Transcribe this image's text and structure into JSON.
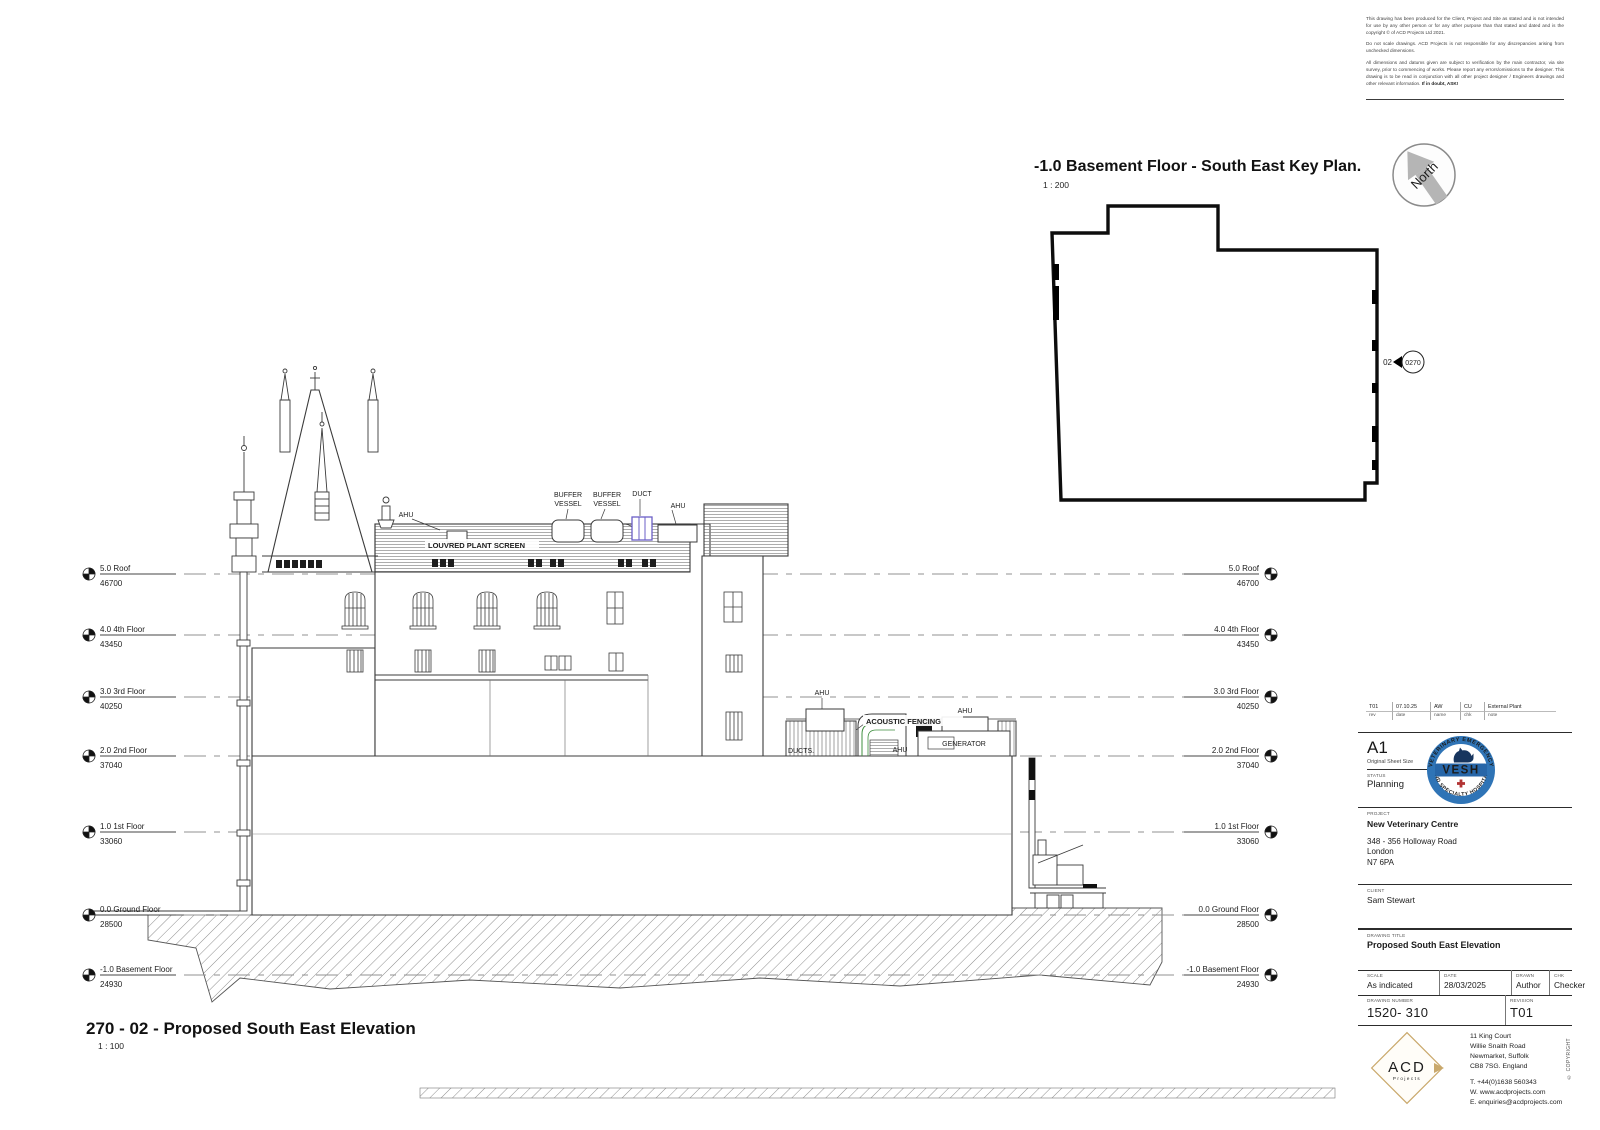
{
  "disclaimer": {
    "p1": "This drawing has been produced for the Client, Project and Site as stated and is not intended for use by any other person or for any other purpose than that stated and dated and is the copyright © of ACD Projects Ltd 2021.",
    "p2": "Do not scale drawings. ACD Projects is not responsible for any discrepancies arising from unchecked dimensions.",
    "p3": "All dimensions and datums given are subject to verification by the main contractor, via site survey, prior to commencing of works. Please report any errors/omissions to the designer. This drawing is to be read in conjunction with all other project designer / Engineers drawings and other relevant information. ",
    "p3_bold": "If in doubt, ASK!"
  },
  "key_plan": {
    "title": "-1.0 Basement Floor - South East Key Plan.",
    "scale": "1 : 200",
    "north_label": "North",
    "marker": {
      "view": "02",
      "detail": "0270"
    }
  },
  "elevation": {
    "title": "270 - 02 - Proposed South East Elevation",
    "scale": "1 : 100",
    "levels": [
      {
        "name": "5.0 Roof",
        "value": "46700"
      },
      {
        "name": "4.0 4th Floor",
        "value": "43450"
      },
      {
        "name": "3.0 3rd Floor",
        "value": "40250"
      },
      {
        "name": "2.0 2nd Floor",
        "value": "37040"
      },
      {
        "name": "1.0 1st Floor",
        "value": "33060"
      },
      {
        "name": "0.0 Ground Floor",
        "value": "28500"
      },
      {
        "name": "-1.0 Basement Floor",
        "value": "24930"
      }
    ],
    "labels": {
      "ahu": "AHU",
      "buffer": "BUFFER",
      "vessel": "VESSEL",
      "duct": "DUCT",
      "louvred_plant_screen": "LOUVRED PLANT SCREEN",
      "acoustic_fencing": "ACOUSTIC FENCING",
      "generator": "GENERATOR",
      "ducts": "DUCTS."
    }
  },
  "title_block": {
    "revision_row": {
      "rev": "T01",
      "date": "07.10.25",
      "name": "AW",
      "chk": "CU",
      "note": "External Plant",
      "labels": {
        "rev": "rev",
        "date": "date",
        "name": "name",
        "chk": "chk",
        "note": "note"
      }
    },
    "sheet": {
      "size": "A1",
      "size_label": "Original Sheet Size"
    },
    "status": {
      "label": "STATUS",
      "value": "Planning"
    },
    "logo_vesh": {
      "top": "VETERINARY EMERGENCY",
      "name": "VESH",
      "bottom": "AND SPECIALTY HOSPITAL"
    },
    "project": {
      "label": "PROJECT",
      "name": "New Veterinary Centre",
      "address1": "348 - 356 Holloway Road",
      "address2": "London",
      "address3": "N7 6PA"
    },
    "client": {
      "label": "CLIENT",
      "name": "Sam Stewart"
    },
    "drawing_title": {
      "label": "DRAWING TITLE",
      "value": "Proposed South East Elevation"
    },
    "scale": {
      "label": "SCALE",
      "value": "As indicated"
    },
    "date": {
      "label": "DATE",
      "value": "28/03/2025"
    },
    "drawn": {
      "label": "DRAWN",
      "value": "Author"
    },
    "chk": {
      "label": "CHK",
      "value": "Checker"
    },
    "drawing_number": {
      "label": "DRAWING NUMBER",
      "value": "1520- 310"
    },
    "revision": {
      "label": "REVISION",
      "value": "T01"
    },
    "firm": {
      "name": "ACD",
      "sub": "Projects",
      "addr1": "11 King Court",
      "addr2": "Willie Snaith Road",
      "addr3": "Newmarket, Suffolk",
      "addr4": "CB8 7SG. England",
      "tel": "T. +44(0)1638 560343",
      "web": "W. www.acdprojects.com",
      "email": "E. enquiries@acdprojects.com"
    },
    "copyright": "© COPYRIGHT"
  }
}
